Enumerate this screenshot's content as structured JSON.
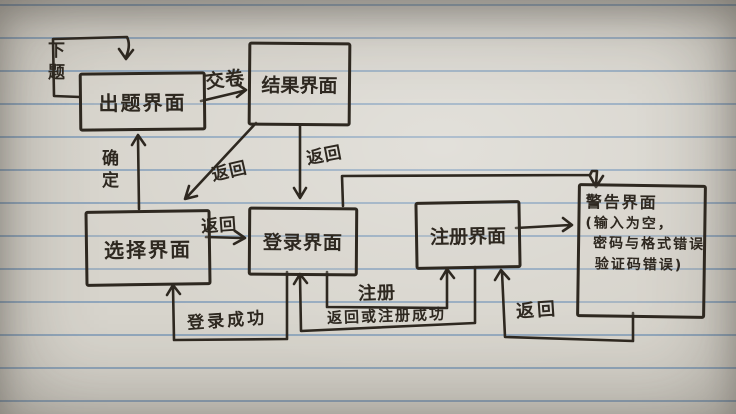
{
  "diagram": {
    "title": "hand-drawn app screen flow diagram on lined notebook paper",
    "nodes": {
      "question": {
        "label": "出题界面"
      },
      "result": {
        "label": "结果界面"
      },
      "select": {
        "label": "选择界面"
      },
      "login": {
        "label": "登录界面"
      },
      "register": {
        "label": "注册界面"
      },
      "warning": {
        "line1": "警告界面",
        "line2": "(输入为空，",
        "line3": "密码与格式错误",
        "line4": "验证码错误)"
      }
    },
    "edges": {
      "next_question": {
        "label": "下题",
        "from": "出题界面",
        "to": "出题界面"
      },
      "submit": {
        "label": "交卷",
        "from": "出题界面",
        "to": "结果界面"
      },
      "confirm": {
        "label": "确定",
        "from": "选择界面",
        "to": "出题界面"
      },
      "back_result_select": {
        "label": "返回",
        "from": "结果界面",
        "to": "选择界面"
      },
      "back_result_login": {
        "label": "返回",
        "from": "结果界面",
        "to": "登录界面"
      },
      "back_select_login": {
        "label": "返回",
        "from": "选择界面",
        "to": "登录界面"
      },
      "login_to_warning": {
        "label": "",
        "from": "登录界面",
        "to": "警告界面"
      },
      "register_to_warning": {
        "label": "",
        "from": "注册界面",
        "to": "警告界面"
      },
      "login_success": {
        "label": "登录成功",
        "from": "登录界面",
        "to": "选择界面"
      },
      "register_action": {
        "label": "注册",
        "from": "登录界面",
        "to": "注册界面"
      },
      "back_or_register_success": {
        "label": "返回或注册成功",
        "from": "注册界面",
        "to": "登录界面"
      },
      "back_warning_register": {
        "label": "返回",
        "from": "警告界面",
        "to": "注册界面"
      }
    },
    "colors": {
      "ink": "#2e2820",
      "paper": "#d7d4cc",
      "ruled_line": "#688cb2"
    }
  }
}
